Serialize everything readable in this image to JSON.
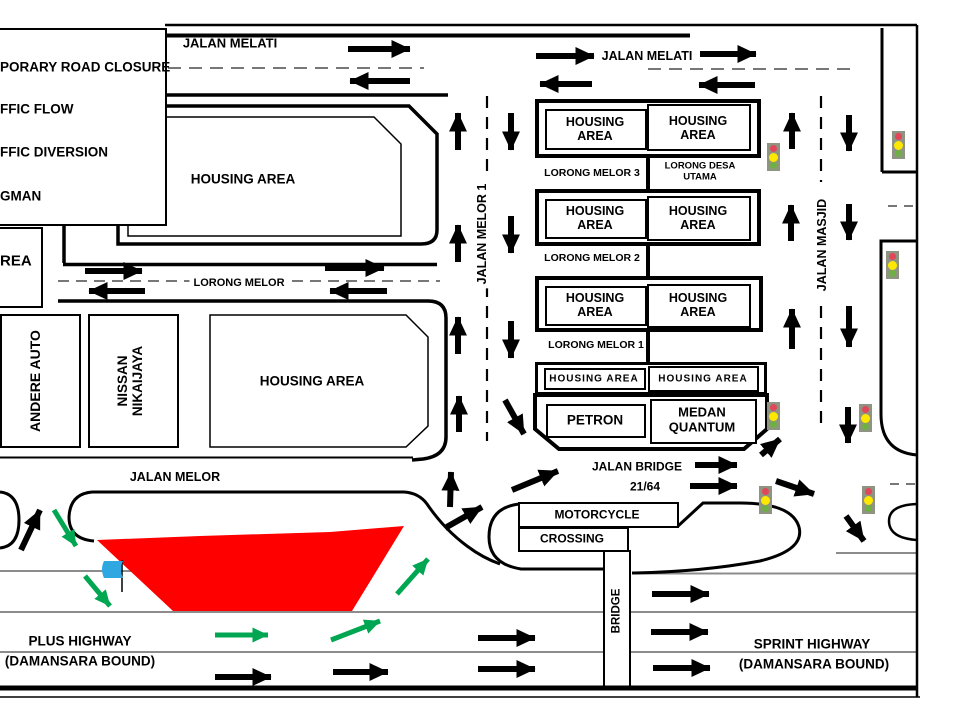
{
  "legend": {
    "lines": [
      "PORARY ROAD CLOSURE",
      "FFIC FLOW",
      "FFIC DIVERSION",
      "GMAN"
    ]
  },
  "streets": {
    "jalan_melati_left": "JALAN MELATI",
    "jalan_melati_right": "JALAN MELATI",
    "jalan_melor_1_vertical": "JALAN MELOR 1",
    "jalan_masjid": "JALAN MASJID",
    "lorong_melor": "LORONG MELOR",
    "jalan_melor": "JALAN MELOR",
    "lorong_melor_3": "LORONG MELOR 3",
    "lorong_desa_utama": "LORONG DESA UTAMA",
    "lorong_melor_2": "LORONG MELOR 2",
    "lorong_melor_1": "LORONG MELOR 1",
    "jalan_bridge_line1": "JALAN BRIDGE",
    "jalan_bridge_line2": "21/64",
    "bridge": "BRIDGE",
    "motorcycle": "MOTORCYCLE",
    "crossing": "CROSSING"
  },
  "areas": {
    "housing_upper": "HOUSING AREA",
    "housing_middle": "HOUSING AREA",
    "housing_left_cut": "REA",
    "andere_auto": "ANDERE AUTO",
    "nissan": "NISSAN NIKAIJAYA",
    "blocks": [
      {
        "left": "HOUSING AREA",
        "right": "HOUSING AREA"
      },
      {
        "left": "HOUSING AREA",
        "right": "HOUSING AREA"
      },
      {
        "left": "HOUSING AREA",
        "right": "HOUSING AREA"
      },
      {
        "left": "HOUSING AREA",
        "right": "HOUSING AREA"
      },
      {
        "left": "PETRON",
        "right": "MEDAN QUANTUM"
      }
    ]
  },
  "highways": {
    "plus_line1": "PLUS HIGHWAY",
    "plus_line2": "(DAMANSARA BOUND)",
    "sprint_line1": "SPRINT HIGHWAY",
    "sprint_line2": "(DAMANSARA BOUND)"
  },
  "colors": {
    "closure_red": "#FF0000",
    "diversion_green": "#00A651",
    "flag_blue": "#2FA8E1",
    "road_black": "#000000",
    "lane_gray": "#8C8C8C"
  },
  "icons": {
    "traffic_light": "traffic-light-icon",
    "flag": "flagman-flag-icon"
  }
}
